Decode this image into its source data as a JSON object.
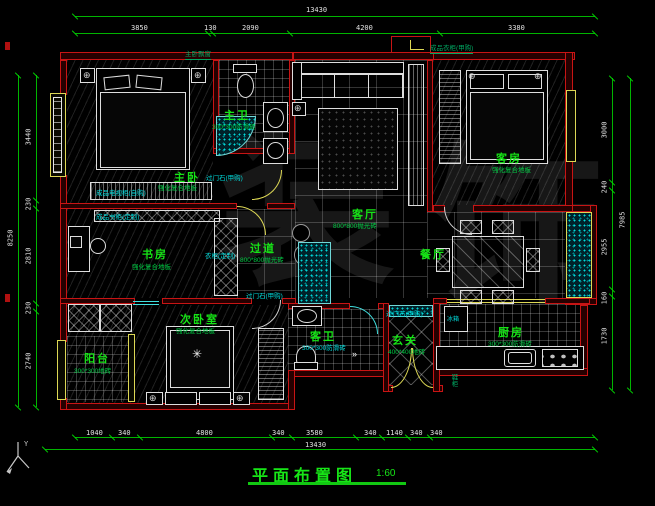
{
  "title": {
    "text": "平面布置图",
    "scale": "1:60"
  },
  "axis": {
    "label": "Y"
  },
  "watermark": {
    "char1": "装",
    "char2": "饰"
  },
  "colors": {
    "wall_red": "#c81414",
    "dim_green": "#00b400",
    "label_green": "#16e316",
    "annotation_cyan": "#00dcdc",
    "window_yellow": "#ddd855",
    "dim_text": "#e2e2e2"
  },
  "dims": {
    "top": {
      "total": "13430",
      "s0": "3850",
      "s1": "130",
      "s2": "2090",
      "s3": "4200",
      "s4": "3380"
    },
    "left": {
      "total": "8250",
      "s0": "3440",
      "s1": "230",
      "s2": "2810",
      "s3": "230",
      "s4": "2740"
    },
    "right": {
      "total": "7985",
      "s0": "3000",
      "s1": "240",
      "s2": "2955",
      "s3": "160",
      "s4": "1730"
    },
    "bottom": {
      "total": "13430",
      "s0": "1040",
      "s1": "340",
      "s2": "4800",
      "s3": "340",
      "s4": "3580",
      "s5": "340",
      "s6": "1140",
      "s7": "340",
      "s8": "340"
    }
  },
  "rooms": {
    "master": {
      "name": "主卧",
      "finish": "强化复合地板"
    },
    "masterBath": {
      "name": "主卫",
      "finish": "300*300防滑砖"
    },
    "living": {
      "name": "客厅",
      "finish": "800*800抛光砖"
    },
    "guest": {
      "name": "客房",
      "finish": "强化复合地板"
    },
    "study": {
      "name": "书房",
      "finish": "强化复合地板"
    },
    "hallway": {
      "name": "过道",
      "finish": "800*800抛光砖"
    },
    "dining": {
      "name": "餐厅"
    },
    "kitchen": {
      "name": "厨房",
      "finish": "300*300防滑砖"
    },
    "entry": {
      "name": "玄关",
      "finish": "400*400地砖"
    },
    "guestBath": {
      "name": "客卫",
      "finish": "300*300防滑砖"
    },
    "second": {
      "name": "次卧室",
      "finish": "强化复合地板"
    },
    "balcony": {
      "name": "阳台",
      "finish": "300*300地砖"
    }
  },
  "annotations": {
    "wardrobeTop": "成品衣柜(甲购)",
    "bayWindow": "主卧飘窗",
    "doorStone1": "过门石(甲购)",
    "doorStone2": "过门石(甲购)",
    "doorStone3": "过门石(甲购)",
    "tvCabinet": "成品电视柜(自购)",
    "bookcase": "成品书柜(定制)",
    "wardrobeStudy": "衣柜(定制)",
    "fridge": "冰箱",
    "shoeCabinet": "鞋柜"
  }
}
